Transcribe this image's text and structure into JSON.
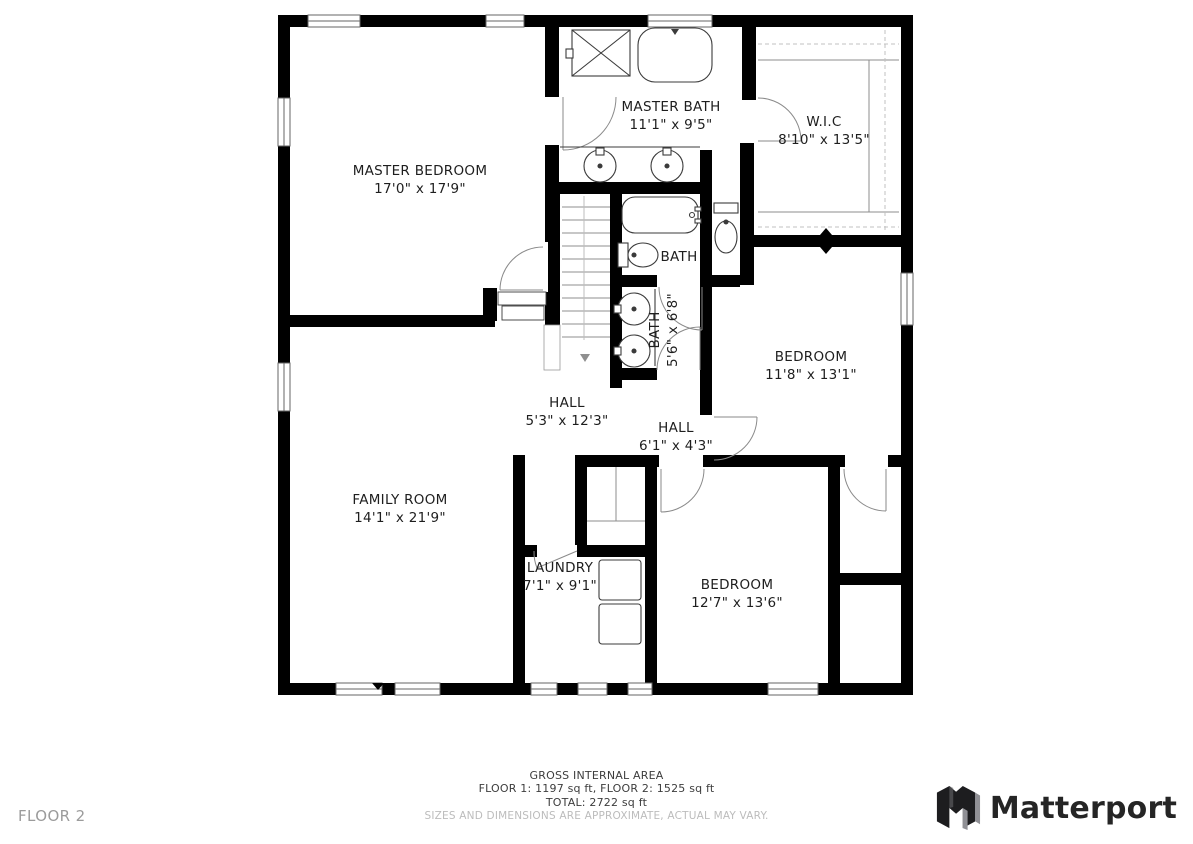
{
  "floor_label": "FLOOR 2",
  "brand": {
    "name": "Matterport"
  },
  "footer": {
    "gross_internal_area": "GROSS INTERNAL AREA",
    "floors": "FLOOR 1: 1197 sq ft, FLOOR 2: 1525 sq ft",
    "total": "TOTAL: 2722 sq ft",
    "disclaimer": "SIZES AND DIMENSIONS ARE APPROXIMATE, ACTUAL MAY VARY."
  },
  "rooms": [
    {
      "id": "master-bedroom",
      "name": "MASTER BEDROOM",
      "dims": "17'0\" x 17'9\""
    },
    {
      "id": "master-bath",
      "name": "MASTER BATH",
      "dims": "11'1\" x 9'5\""
    },
    {
      "id": "wic",
      "name": "W.I.C",
      "dims": "8'10\" x 13'5\""
    },
    {
      "id": "bath",
      "name": "BATH",
      "dims": ""
    },
    {
      "id": "bath-2",
      "name": "BATH",
      "dims": "5'6\" x 6'8\""
    },
    {
      "id": "bedroom-1",
      "name": "BEDROOM",
      "dims": "11'8\" x 13'1\""
    },
    {
      "id": "hall-1",
      "name": "HALL",
      "dims": "5'3\" x 12'3\""
    },
    {
      "id": "hall-2",
      "name": "HALL",
      "dims": "6'1\" x 4'3\""
    },
    {
      "id": "family-room",
      "name": "FAMILY ROOM",
      "dims": "14'1\" x 21'9\""
    },
    {
      "id": "laundry",
      "name": "LAUNDRY",
      "dims": "7'1\" x 9'1\""
    },
    {
      "id": "bedroom-2",
      "name": "BEDROOM",
      "dims": "12'7\" x 13'6\""
    }
  ],
  "colors": {
    "wall": "#000000",
    "fixture_line": "#3b3b3b",
    "door_arc": "#8a8a8a",
    "text": "#1e1e1e",
    "muted": "#9b9b9b",
    "disclaimer": "#bcbcbc"
  }
}
